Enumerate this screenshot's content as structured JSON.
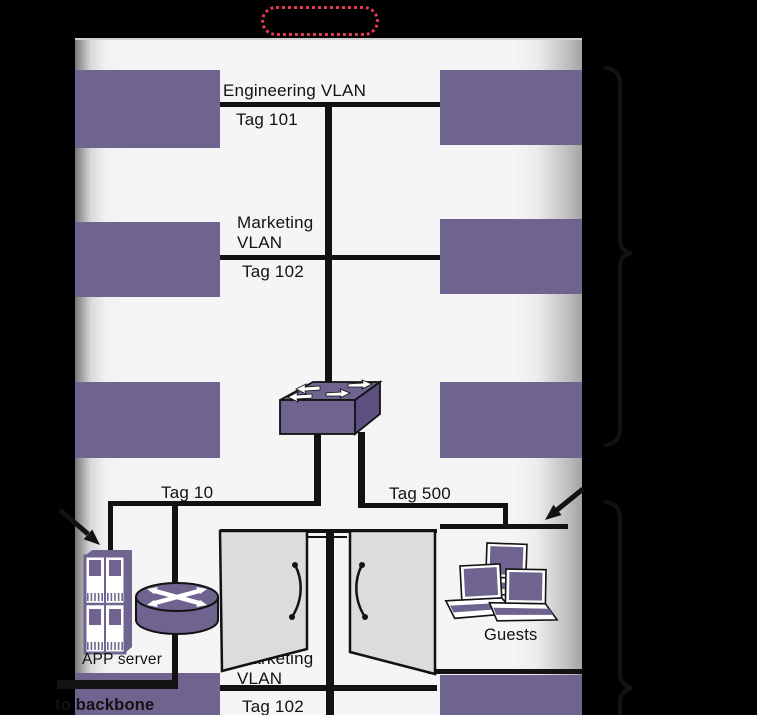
{
  "colors": {
    "ink": "#121212",
    "purple": "#6f6390",
    "purple_dark": "#5b5080",
    "building_bg": "#f4f4f4",
    "door_gray": "#dcdcdc",
    "accent_red": "#e23a55"
  },
  "labels": {
    "engineering_vlan": "Engineering VLAN",
    "tag_101": "Tag 101",
    "marketing_line1": "Marketing",
    "marketing_line2": "VLAN",
    "tag_102": "Tag 102",
    "tag_10": "Tag 10",
    "tag_500": "Tag 500",
    "app_server": "APP server",
    "guests": "Guests",
    "marketing_lower_line1": "Marketing",
    "marketing_lower_line2": "VLAN",
    "tag_102_lower": "Tag 102",
    "to_backbone": "to backbone"
  },
  "icons": {
    "switch": "switch-icon",
    "router": "router-icon",
    "server": "server-icon",
    "laptops": "guest-laptops-icon",
    "callout": "callout-oval",
    "brace_top": "brace-upper-floors",
    "brace_bottom": "brace-lobby"
  }
}
